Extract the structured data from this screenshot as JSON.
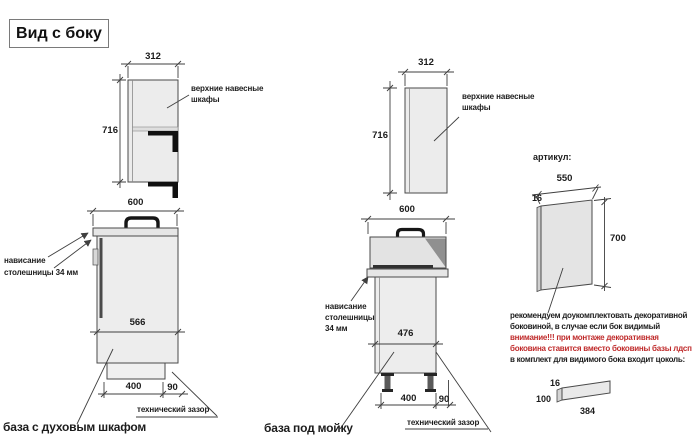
{
  "title": "Вид с боку",
  "colors": {
    "red": "#bf2a2a",
    "line": "#3f3f3f",
    "cabinet_fill": "#ececec"
  },
  "left_view": {
    "upper": {
      "width": "312",
      "height": "716",
      "label_line1": "верхние навесные",
      "label_line2": "шкафы"
    },
    "base": {
      "width": "600",
      "depth": "566",
      "plinth_depth": "400",
      "gap": "90",
      "overhang_line1": "нависание",
      "overhang_line2": "столешницы 34 мм",
      "gap_label": "технический зазор",
      "caption": "база с духовым шкафом"
    }
  },
  "middle_view": {
    "upper": {
      "width": "312",
      "height": "716",
      "label_line1": "верхние навесные",
      "label_line2": "шкафы"
    },
    "base": {
      "width": "600",
      "depth": "476",
      "plinth_depth": "400",
      "gap": "90",
      "overhang_line1": "нависание",
      "overhang_line2": "столешницы",
      "overhang_line3": "34 мм",
      "gap_label": "технический зазор",
      "caption": "база под мойку"
    }
  },
  "right_view": {
    "article_label": "артикул:",
    "panel": {
      "width": "550",
      "thickness": "16",
      "height": "700"
    },
    "note": {
      "line1": "рекомендуем доукомплектовать декоративной",
      "line2": "боковиной, в случае если бок видимый",
      "line3": "внимание!!! при монтаже декоративная",
      "line4": "боковина ставится вместо боковины базы лдсп",
      "line5": "в комплект для видимого бока входит цоколь:"
    },
    "plinth": {
      "thickness": "16",
      "height": "100",
      "length": "384"
    }
  }
}
